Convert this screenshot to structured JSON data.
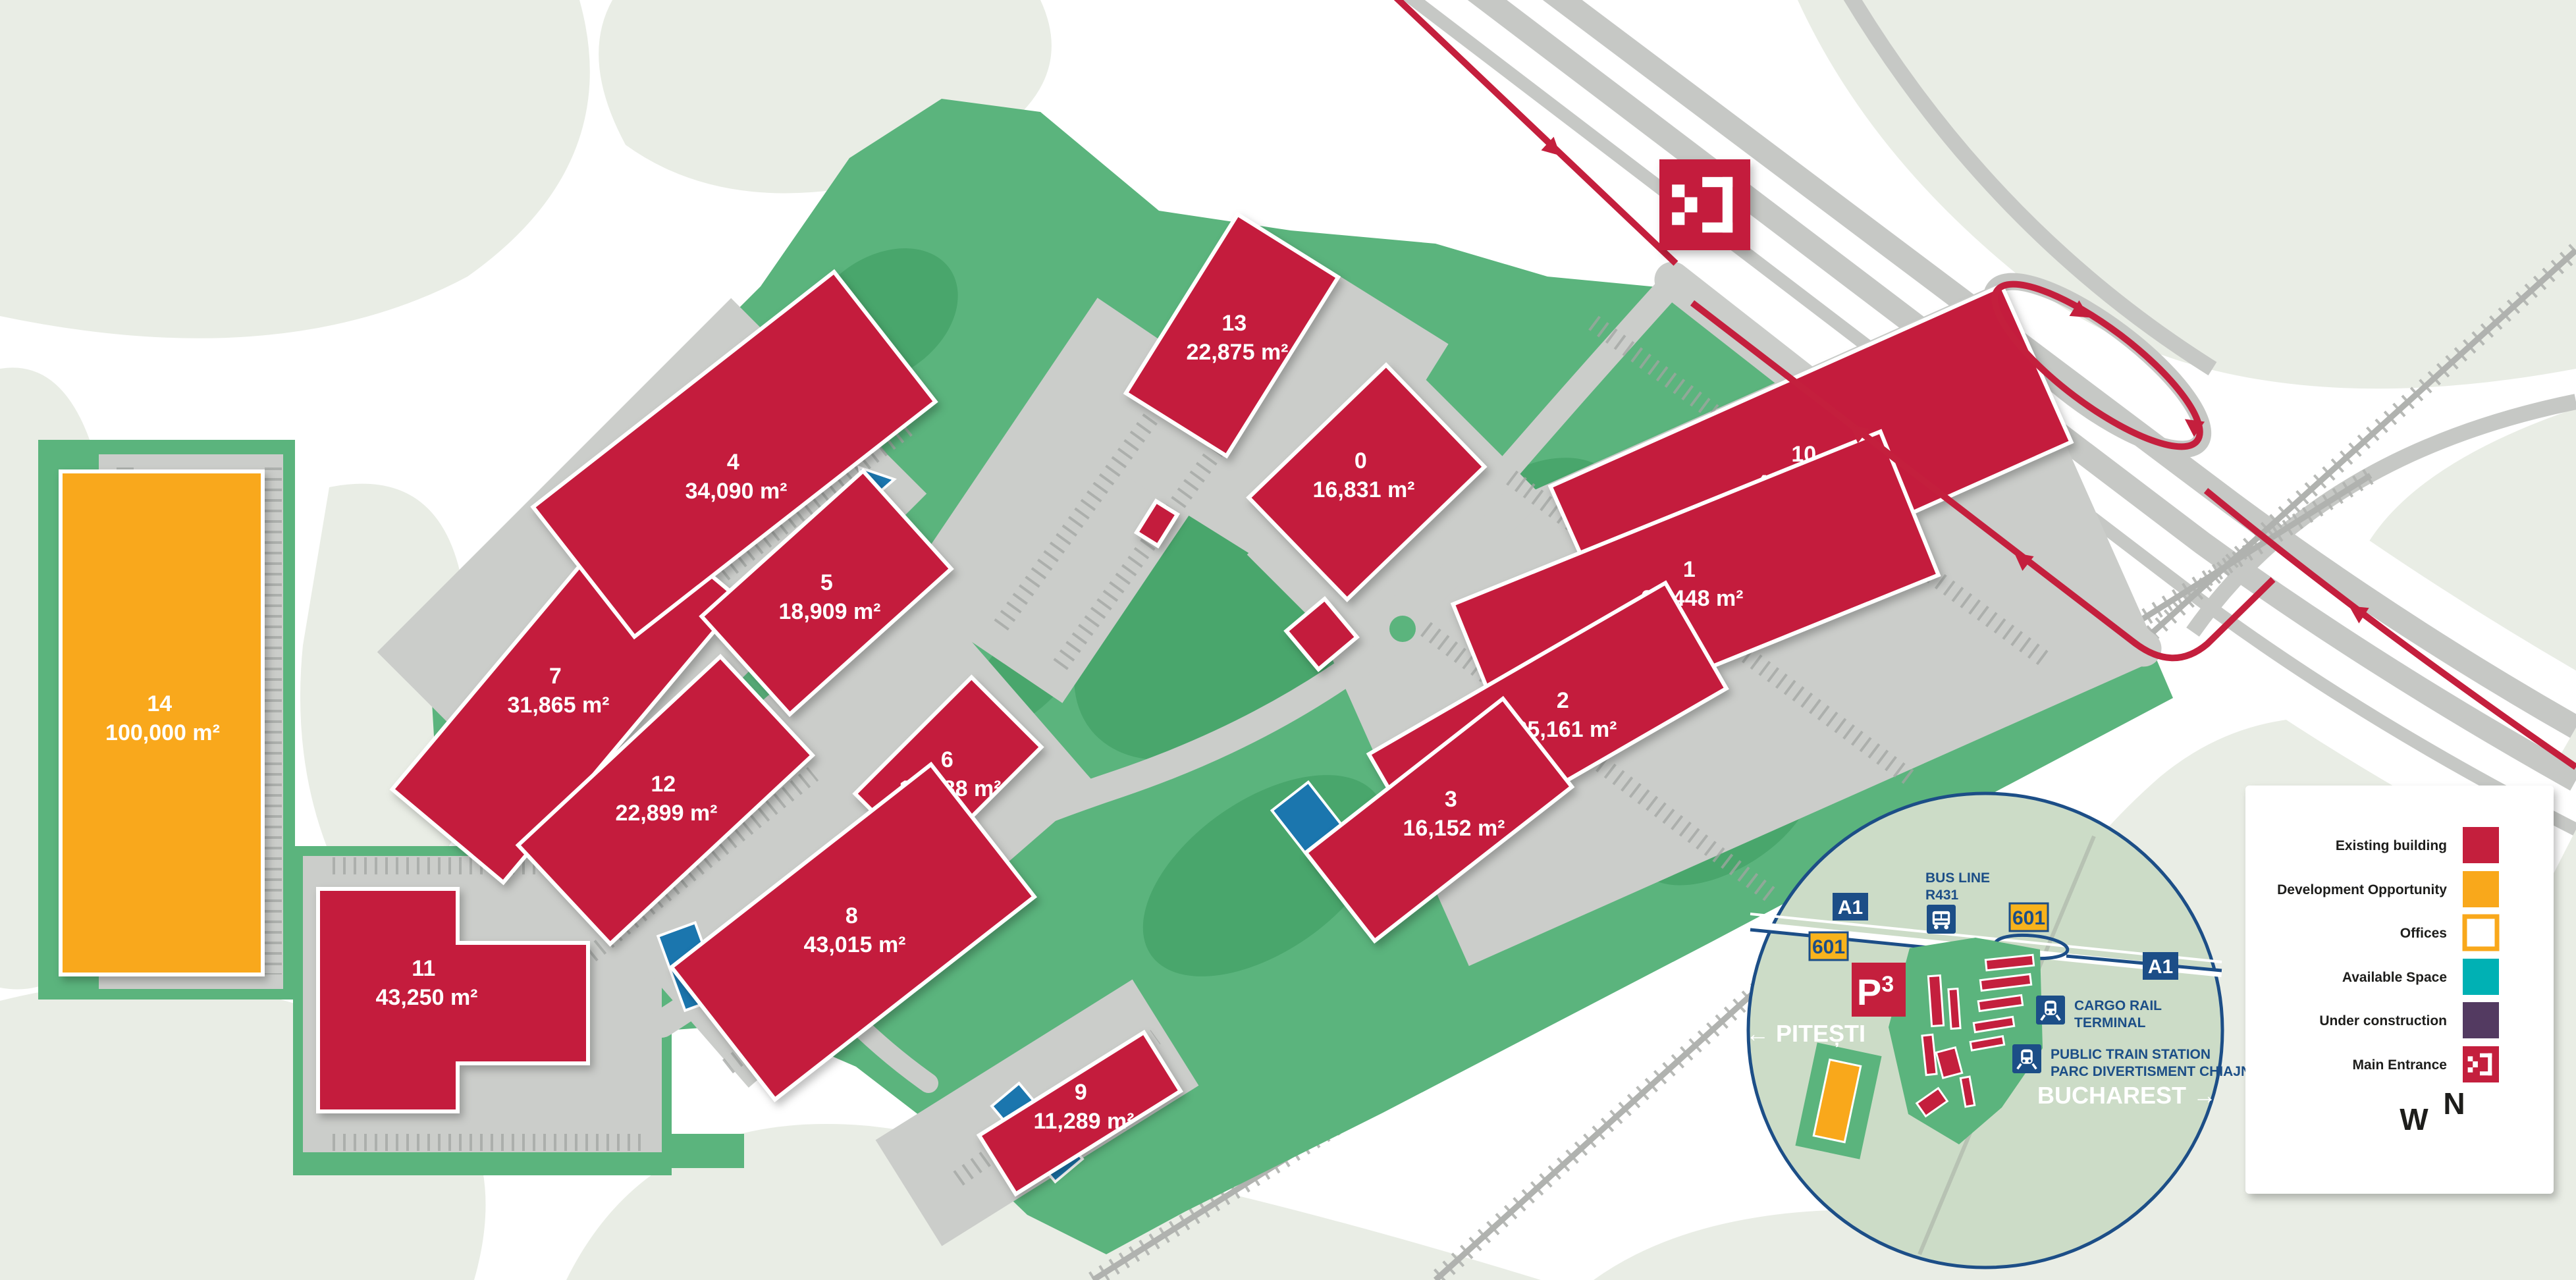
{
  "colors": {
    "existing": "#C41F3D",
    "development": "#F9A81B",
    "available": "#00B1B4",
    "construction": "#533A61",
    "green": "#5BB47D",
    "green_dark": "#49A66C",
    "pond": "#1B76AE",
    "apron": "#CBCDCA",
    "hwy": "#C6C8C5",
    "tick": "#A2A4A1",
    "rail": "#B0B2AF",
    "pale": "#E9EDE5",
    "inset_bg": "#CCDCC7",
    "navy": "#1C4E87",
    "badge_yellow": "#F8B31C",
    "text_dark": "#1D1D1B"
  },
  "buildings": [
    {
      "id": "0",
      "area": "16,831 m²",
      "status": "existing"
    },
    {
      "id": "1",
      "area": "33,448 m²",
      "status": "existing"
    },
    {
      "id": "2",
      "area": "25,161 m²",
      "status": "existing"
    },
    {
      "id": "3",
      "area": "16,152 m²",
      "status": "existing"
    },
    {
      "id": "4",
      "area": "34,090 m²",
      "status": "existing"
    },
    {
      "id": "5",
      "area": "18,909 m²",
      "status": "existing"
    },
    {
      "id": "6",
      "area": "14,188 m²",
      "status": "existing"
    },
    {
      "id": "7",
      "area": "31,865 m²",
      "status": "existing"
    },
    {
      "id": "8",
      "area": "43,015 m²",
      "status": "existing"
    },
    {
      "id": "9",
      "area": "11,289 m²",
      "status": "existing"
    },
    {
      "id": "10",
      "area": "45,646 m²",
      "status": "existing"
    },
    {
      "id": "11",
      "area": "43,250 m²",
      "status": "existing"
    },
    {
      "id": "12",
      "area": "22,899 m²",
      "status": "existing"
    },
    {
      "id": "13",
      "area": "22,875 m²",
      "status": "existing"
    },
    {
      "id": "14",
      "area": "100,000 m²",
      "status": "development"
    }
  ],
  "legend": {
    "items": [
      {
        "label": "Existing building",
        "type": "existing"
      },
      {
        "label": "Development Opportunity",
        "type": "development"
      },
      {
        "label": "Offices",
        "type": "offices"
      },
      {
        "label": "Available Space",
        "type": "available"
      },
      {
        "label": "Under construction",
        "type": "construction"
      },
      {
        "label": "Main Entrance",
        "type": "entrance"
      }
    ]
  },
  "compass": {
    "west": "W",
    "north": "N"
  },
  "inset": {
    "badge_a1": "A1",
    "badge_601": "601",
    "bus_line_1": "BUS LINE",
    "bus_line_2": "R431",
    "cargo_1": "CARGO RAIL",
    "cargo_2": "TERMINAL",
    "station_1": "PUBLIC TRAIN STATION",
    "station_2": "PARC DIVERTISMENT CHIAJNA",
    "west_city": "← PITEȘTI",
    "east_city": "BUCHAREST →",
    "logo_p": "P",
    "logo_3": "3"
  }
}
